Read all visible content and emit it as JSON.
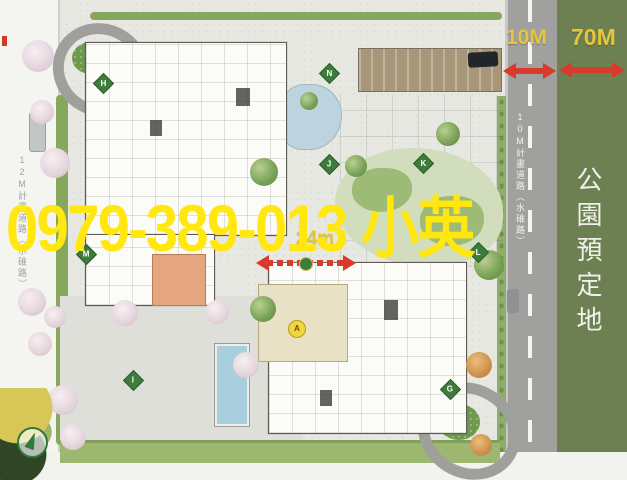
{
  "watermark": {
    "text": "0979-389-013 小英",
    "color": "#ffe70f"
  },
  "labels": {
    "road_width": "10M",
    "park_width": "70M",
    "court_width": "24m"
  },
  "roads": {
    "left_label": "12M計畫道路（水碓路）",
    "right_label": "10M計畫道路（水碓路）"
  },
  "park": {
    "label": "公園預定地",
    "color": "#6d8052"
  },
  "badges": [
    {
      "letter": "H"
    },
    {
      "letter": "N"
    },
    {
      "letter": "J"
    },
    {
      "letter": "K"
    },
    {
      "letter": "L"
    },
    {
      "letter": "M"
    },
    {
      "letter": "I"
    },
    {
      "letter": "G"
    },
    {
      "letter": "A"
    }
  ],
  "colors": {
    "watermark_yellow": "#ffe70f",
    "measure_yellow": "#e5c63b",
    "arrow_red": "#d93a2b",
    "road_gray": "#a0a09e",
    "park_green": "#6d8052",
    "badge_green": "#3e7c3c",
    "highlight_unit_orange": "#e5a57f",
    "lobby_beige": "#e9e1c6",
    "pool_blue": "#a9cede"
  }
}
